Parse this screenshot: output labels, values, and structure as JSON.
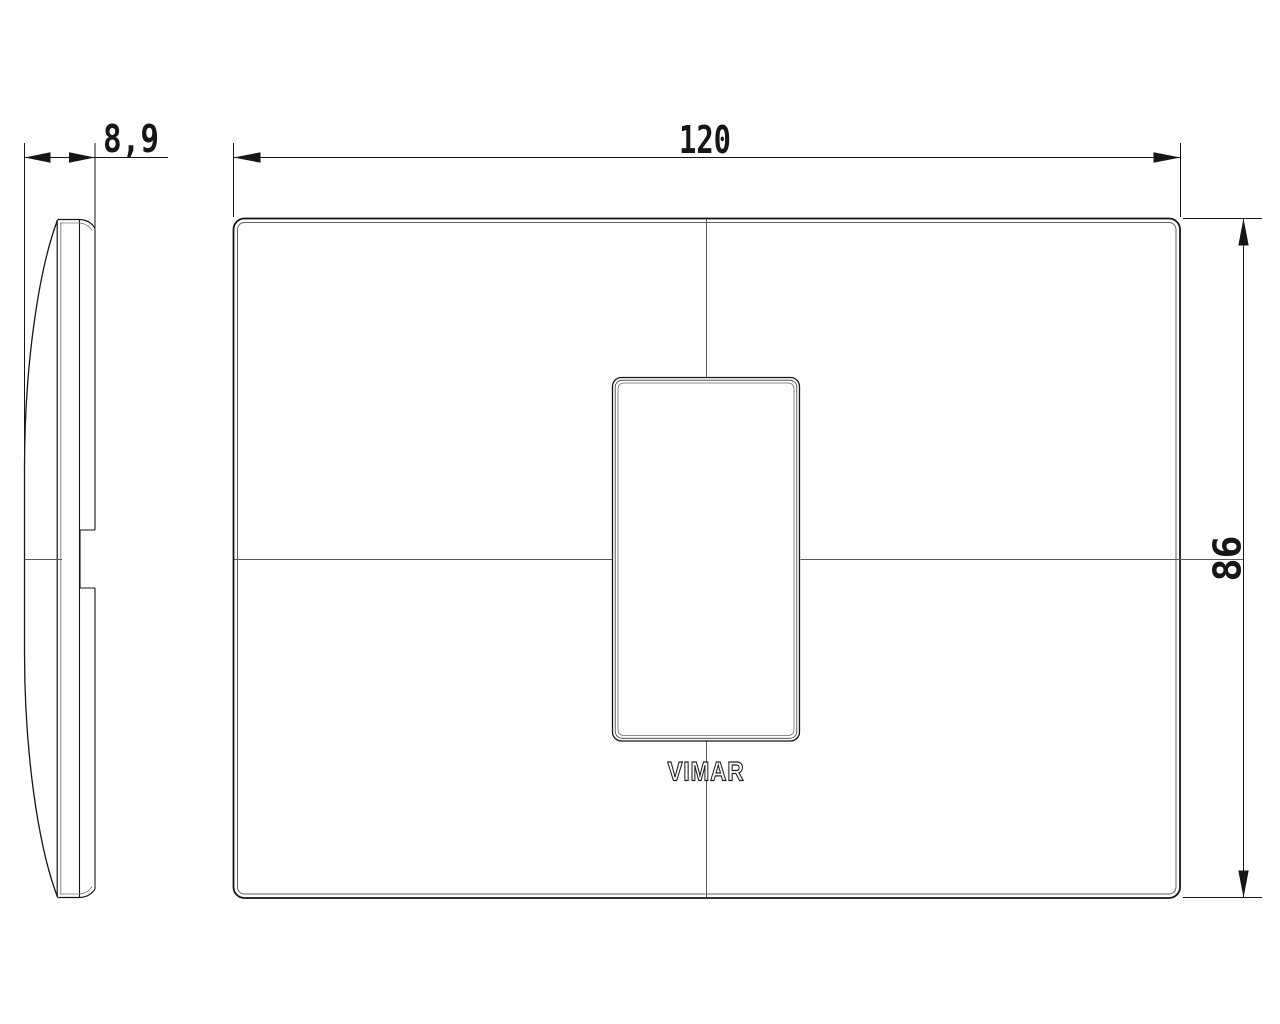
{
  "drawing": {
    "description": "technical-drawing-cover-plate",
    "dimensions": {
      "width_label": "120",
      "height_label": "86",
      "depth_label": "8,9"
    },
    "logo": "VIMAR",
    "colors": {
      "background": "#ffffff",
      "outline": "#161616",
      "secondary_line": "#6a6a6a",
      "centerline": "#5a5a5a"
    }
  }
}
